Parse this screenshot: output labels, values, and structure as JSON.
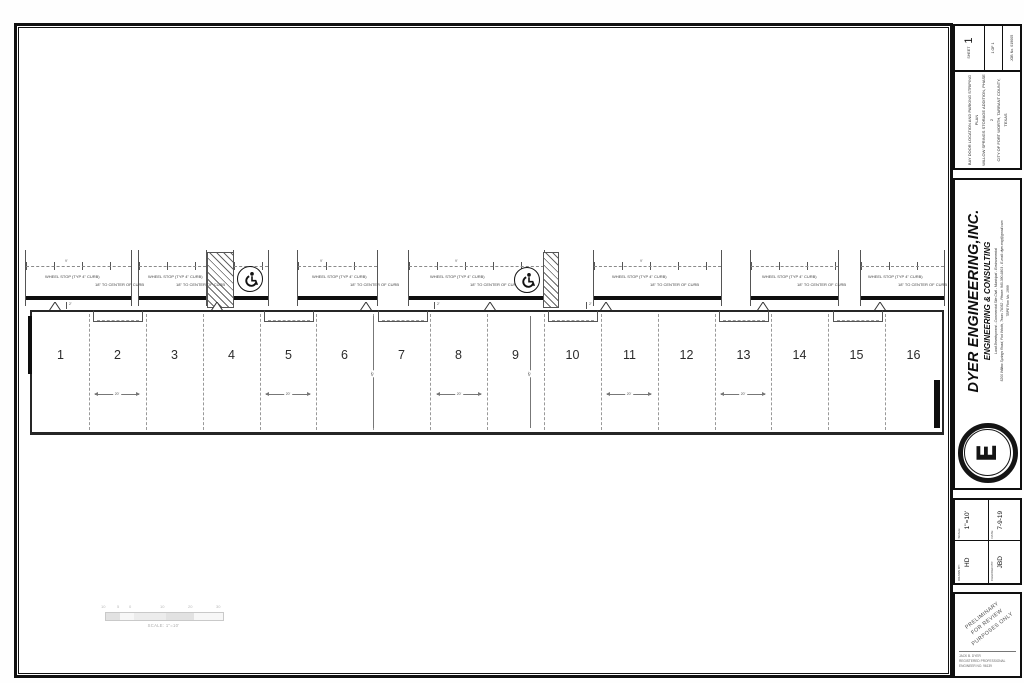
{
  "plan": {
    "stalls": [
      "1",
      "2",
      "3",
      "4",
      "5",
      "6",
      "7",
      "8",
      "9",
      "10",
      "11",
      "12",
      "13",
      "14",
      "15",
      "16"
    ],
    "labels": {
      "wheel_stop": "WHEEL STOP (TYP 4\" CURB)",
      "curb_center": "18\" TO CENTER OF CURB",
      "stall_width_dim": "20'",
      "bay_depth_dim": "45'",
      "door_offset_dim": "2'",
      "stripe_spacing_dim": "9'"
    }
  },
  "scalebar": {
    "ticks": [
      "10",
      "5",
      "0",
      "10",
      "20",
      "30"
    ],
    "caption": "SCALE: 1\"=10'"
  },
  "titleblock": {
    "sheet": {
      "label": "SHEET",
      "number": "1",
      "of": "1 OF 1",
      "job": "JOB No. 019005"
    },
    "project": [
      "BAY DOOR LOCATION AND PARKING STRIPING PLAN",
      "WILLOW SPRINGS STORAGE ADDITION, PHASE 2",
      "CITY OF FORT WORTH, TARRANT COUNTY, TEXAS"
    ],
    "company": {
      "name": "DYER ENGINEERING,INC.",
      "tagline": "ENGINEERING & CONSULTING",
      "line1": "Land Development - Commercial Site Civil - Municipal - Environmental",
      "line2": "5200 Willow Springs Road, Fort Worth, Texas 76052 - Phone: 940-390-6803 - E-mail: dyer.eng@gmail.com",
      "line3": "TBPE Firm No. 1999",
      "logo_letter": "E"
    },
    "info": {
      "drawn_label": "DRAWN BY:",
      "drawn": "HD",
      "scale_label": "SCALE:",
      "scale": "1\"=10'",
      "checked_label": "CHECKED BY:",
      "checked": "JBD",
      "date_label": "DATE:",
      "date": "7-9-19"
    },
    "stamp": {
      "line1": "PRELIMINARY",
      "line2": "FOR REVIEW",
      "line3": "PURPOSES ONLY",
      "reg1": "JACK B. DYER",
      "reg2": "REGISTERED PROFESSIONAL",
      "reg3": "ENGINEER NO. 96139"
    }
  }
}
